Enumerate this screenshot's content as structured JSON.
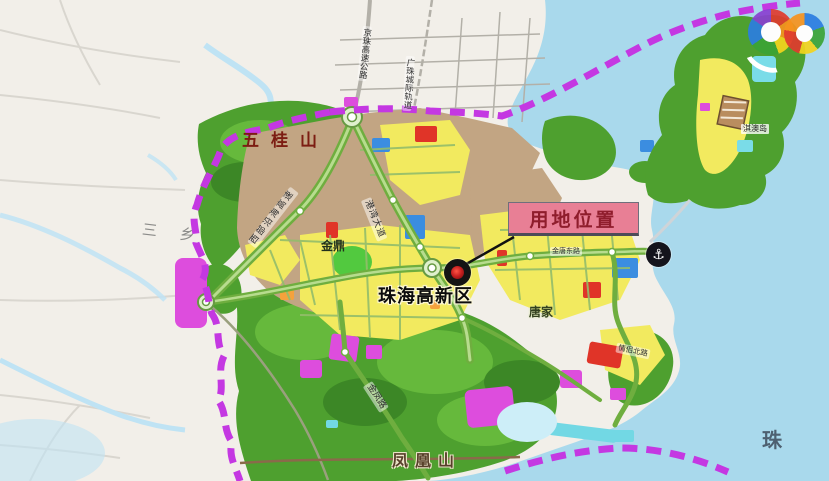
{
  "labels": {
    "wugui_mountain": "五桂山",
    "sanxiang": "三 乡",
    "jinding": "金鼎",
    "zhuhai_hightech_zone": "珠海高新区",
    "tangjia": "唐家",
    "fenghuang_mountain": "凤凰山",
    "qiao_island": "淇澳岛",
    "zhu_partial": "珠"
  },
  "roads": {
    "western_coastal_expressway": "西部沿海高速",
    "gangwan_avenue": "港湾大道",
    "jinfeng_road": "金凤路",
    "jingzhu_expressway": "京珠高速公路",
    "guangzhu_intercity_rail": "广珠城际轨道",
    "qinglv_north_road": "情侣北路",
    "jintang_east_road": "金唐东路"
  },
  "callout": {
    "site_location_label": "用地位置"
  },
  "icons": {
    "port_anchor_icon": "⚓"
  },
  "colors": {
    "sea": "#a9d9ec",
    "outer_land": "#f2efe9",
    "forest_green": "#4ea02f",
    "urban_brown": "#c2a583",
    "zone_yellow": "#f2ea5f",
    "zone_magenta": "#dd4ddd",
    "zone_red": "#e03428",
    "zone_blue": "#3b8de0",
    "boundary_purple": "#c438e2",
    "callout_background": "#e87f95",
    "callout_text": "#8f1d2c"
  }
}
